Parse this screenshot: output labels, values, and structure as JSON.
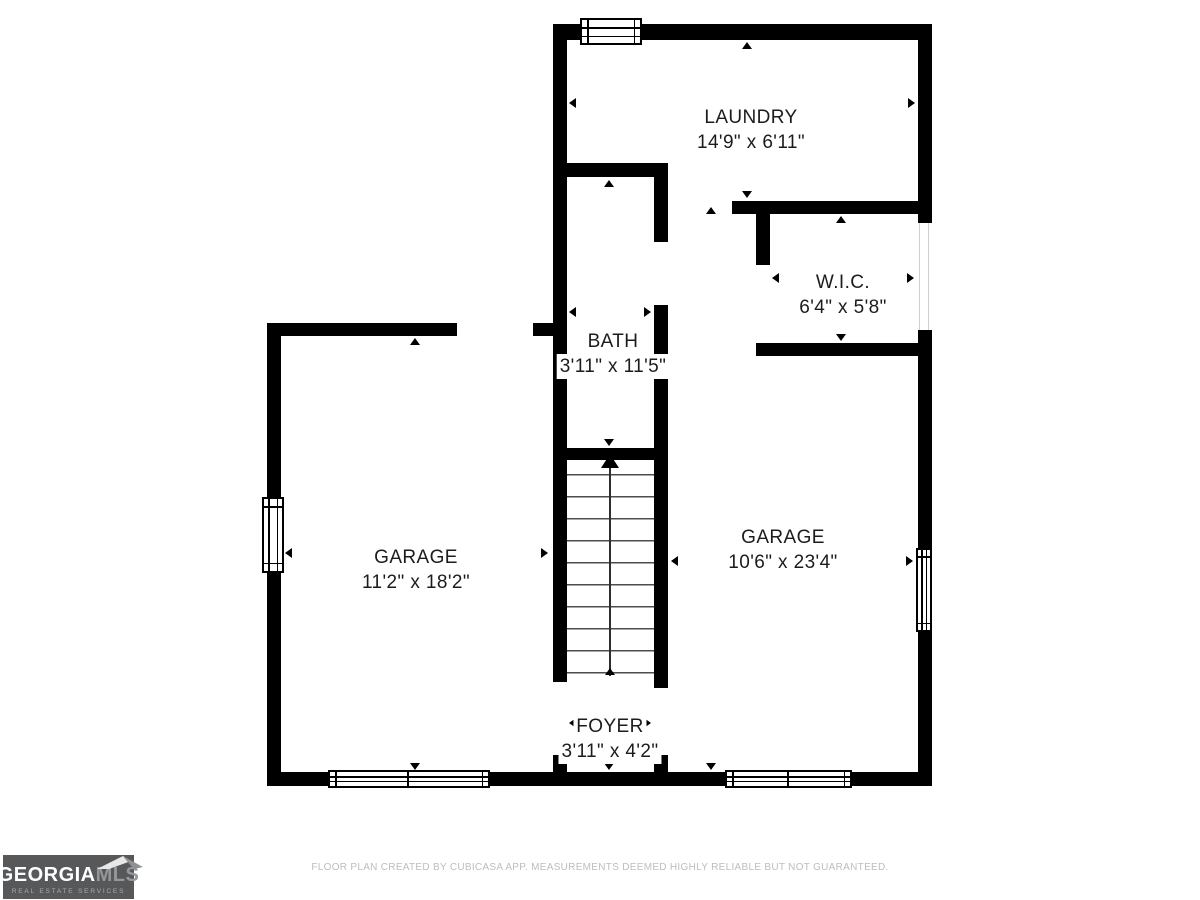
{
  "page": {
    "background": "#ffffff"
  },
  "floorplan": {
    "rooms": [
      {
        "name": "LAUNDRY",
        "dims": "14'9\" x 6'11\""
      },
      {
        "name": "W.I.C.",
        "dims": "6'4\" x 5'8\""
      },
      {
        "name": "BATH",
        "dims": "3'11\" x 11'5\""
      },
      {
        "name": "GARAGE",
        "dims": "11'2\" x 18'2\""
      },
      {
        "name": "GARAGE",
        "dims": "10'6\" x 23'4\""
      },
      {
        "name": "FOYER",
        "dims": "3'11\" x 4'2\""
      }
    ],
    "colors": {
      "wall": "#000000",
      "label_text": "#1c1c1c",
      "stair_tread": "#4d4d4d"
    }
  },
  "footer": {
    "disclaimer": "FLOOR PLAN CREATED BY CUBICASA APP. MEASUREMENTS DEEMED HIGHLY RELIABLE BUT NOT GUARANTEED."
  },
  "logo": {
    "brand_primary": "GEORGIA",
    "brand_secondary": "MLS",
    "tagline": "REAL ESTATE SERVICES",
    "colors": {
      "background": "#57585a",
      "primary": "#ffffff",
      "secondary": "#95979a"
    }
  }
}
